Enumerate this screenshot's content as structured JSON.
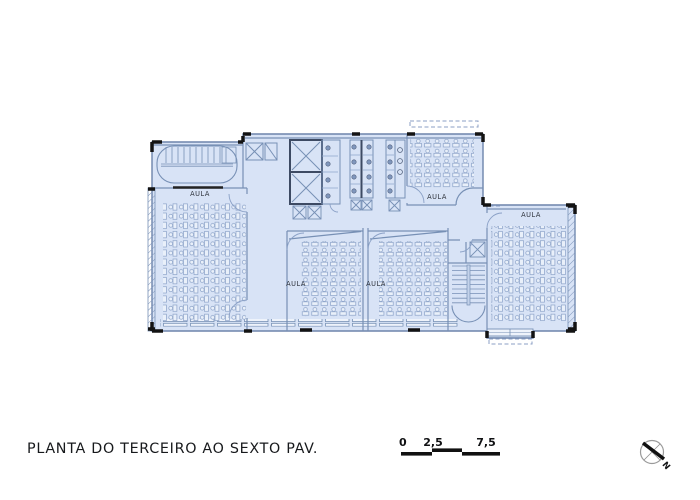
{
  "sheet": {
    "title": "PLANTA DO TERCEIRO AO SEXTO PAV.",
    "room_labels": {
      "left": "AULA",
      "top": "AULA",
      "center_left": "AULA",
      "center_right": "AULA",
      "right": "AULA"
    },
    "scale_bar": {
      "ticks": [
        "0",
        "2,5",
        "7,5"
      ]
    },
    "north_label": "N",
    "colors": {
      "plan_fill": "#d8e3f6",
      "line": "#7d92b7",
      "wall_black": "#131313",
      "desk_fill": "#e9f0fa"
    }
  }
}
